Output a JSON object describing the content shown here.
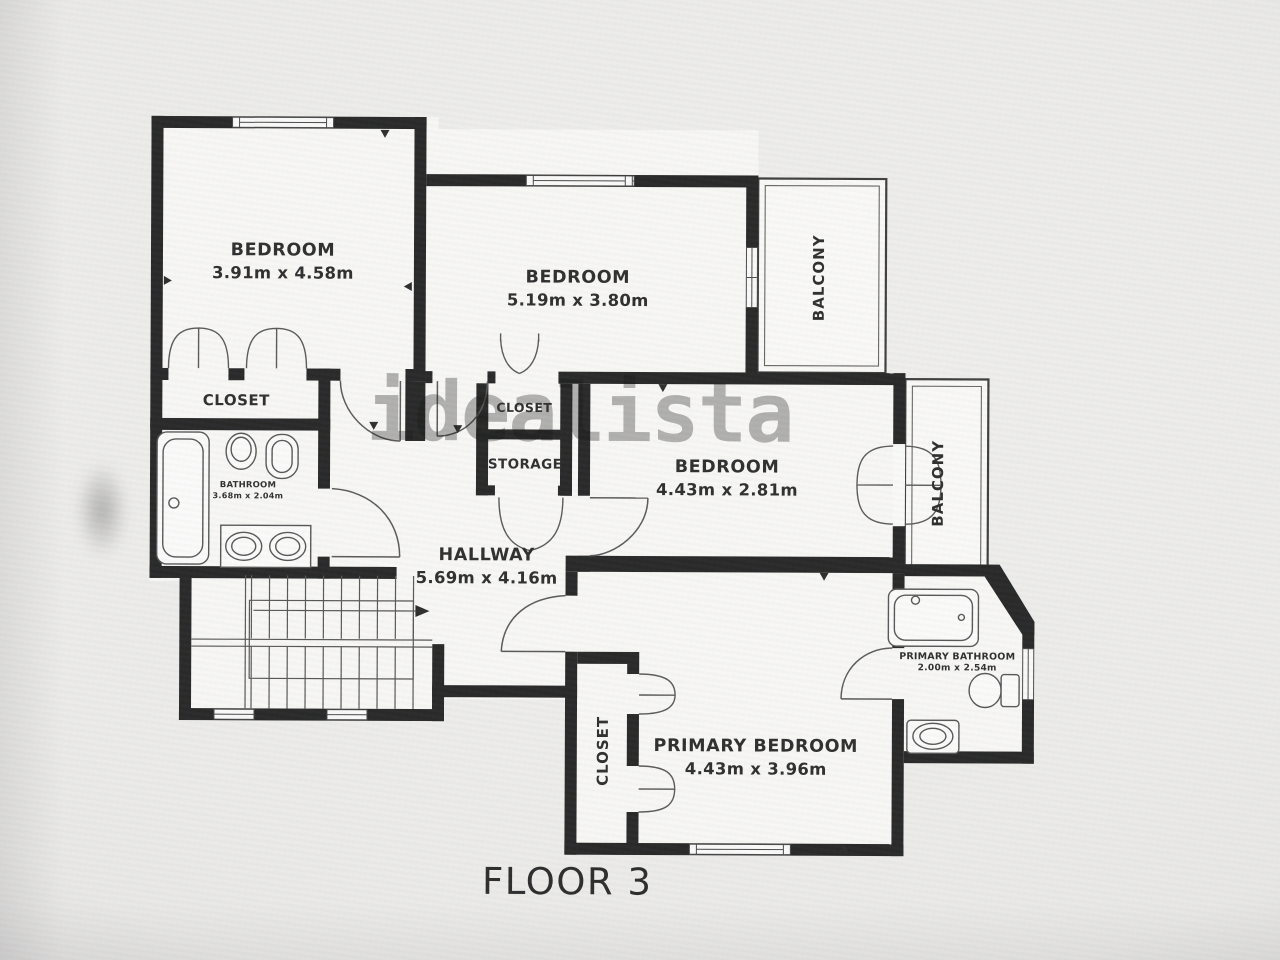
{
  "floor_title": "FLOOR 3",
  "watermark": "idealista",
  "labels": {
    "bedroom1": {
      "name": "BEDROOM",
      "dims": "3.91m x 4.58m"
    },
    "bedroom2": {
      "name": "BEDROOM",
      "dims": "5.19m x 3.80m"
    },
    "bedroom3": {
      "name": "BEDROOM",
      "dims": "4.43m x 2.81m"
    },
    "primary_bedroom": {
      "name": "PRIMARY BEDROOM",
      "dims": "4.43m x 3.96m"
    },
    "hallway": {
      "name": "HALLWAY",
      "dims": "5.69m x 4.16m"
    },
    "bathroom": {
      "name": "BATHROOM",
      "dims": "3.68m x 2.04m"
    },
    "primary_bathroom": {
      "name": "PRIMARY BATHROOM",
      "dims": "2.00m x 2.54m"
    },
    "closet1": {
      "name": "CLOSET"
    },
    "closet2": {
      "name": "CLOSET"
    },
    "storage": {
      "name": "STORAGE"
    },
    "closet_primary": {
      "name": "CLOSET"
    },
    "balcony1": {
      "name": "BALCONY"
    },
    "balcony2": {
      "name": "BALCONY"
    }
  },
  "colors": {
    "wall": "#171717",
    "label_text": "#1e1e1e",
    "watermark_gray": "#767676"
  }
}
